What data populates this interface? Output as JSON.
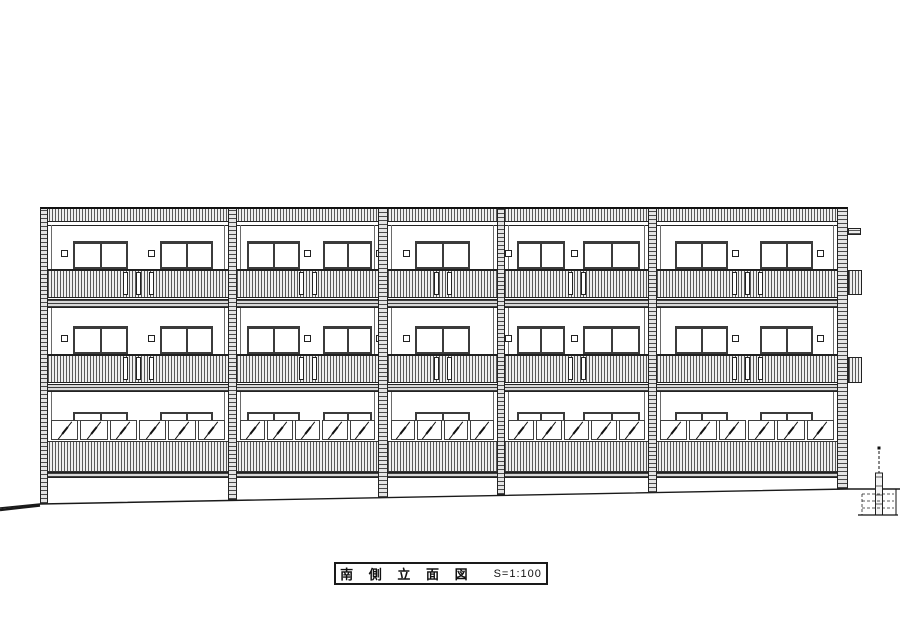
{
  "title_block": {
    "title": "南 側 立 面 図",
    "scale": "S=1:100"
  },
  "drawing": {
    "type": "architectural-elevation-south",
    "canvas": {
      "width": 900,
      "height": 636
    },
    "colors": {
      "line": "#222222",
      "frame": "#3b3b3b",
      "paper": "#ffffff"
    },
    "building": {
      "left": 40,
      "right": 848,
      "top": 207,
      "ground": {
        "pts": "0,508 40,504 848,489 900,489",
        "thick_left": "0,510 40,505.5"
      }
    },
    "levels": {
      "parapet": {
        "top": 207,
        "bottom": 222,
        "subline": 225
      },
      "floors": [
        {
          "name": "3F",
          "window_top": 241,
          "window_bottom": 269,
          "vent_y": 250,
          "balcony_top": 269,
          "balcony_bottom": 298,
          "slab_top": 299,
          "slab_bottom": 308
        },
        {
          "name": "2F",
          "window_top": 326,
          "window_bottom": 354,
          "vent_y": 335,
          "balcony_top": 354,
          "balcony_bottom": 383,
          "slab_top": 384,
          "slab_bottom": 392
        }
      ],
      "ground_floor": {
        "name": "1F",
        "head_top": 412,
        "head_bottom": 421,
        "louver_top": 420,
        "louver_bottom": 440,
        "screen_top": 441,
        "screen_bottom": 472,
        "base_top": 472,
        "base_bottom": 478
      }
    },
    "columns": [
      [
        40,
        48
      ],
      [
        228,
        237
      ],
      [
        378,
        388
      ],
      [
        497,
        505
      ],
      [
        648,
        657
      ],
      [
        837,
        848
      ]
    ],
    "bays": [
      {
        "x": 48,
        "w": 180,
        "vent_side": "left",
        "slots": 3,
        "louvers": 6,
        "windows": [
          {
            "dx": 25,
            "w": 55
          },
          {
            "dx": 112,
            "w": 53
          }
        ]
      },
      {
        "x": 237,
        "w": 141,
        "vent_side": "right",
        "slots": 2,
        "louvers": 5,
        "windows": [
          {
            "dx": 10,
            "w": 53
          },
          {
            "dx": 86,
            "w": 49
          }
        ]
      },
      {
        "x": 388,
        "w": 109,
        "vent_side": "left",
        "slots": 2,
        "louvers": 4,
        "windows": [
          {
            "dx": 27,
            "w": 55
          }
        ]
      },
      {
        "x": 505,
        "w": 143,
        "vent_side": "left",
        "slots": 2,
        "louvers": 5,
        "windows": [
          {
            "dx": 12,
            "w": 48
          },
          {
            "dx": 78,
            "w": 57
          }
        ]
      },
      {
        "x": 657,
        "w": 180,
        "vent_side": "right",
        "slots": 3,
        "louvers": 6,
        "windows": [
          {
            "dx": 18,
            "w": 53
          },
          {
            "dx": 103,
            "w": 53
          }
        ]
      }
    ],
    "right_side": {
      "cap_bar": {
        "x": 848,
        "y": 228,
        "w": 13,
        "h": 7
      },
      "balcony_boxes": [
        {
          "x": 848,
          "y": 270,
          "w": 14,
          "h": 25
        },
        {
          "x": 848,
          "y": 357,
          "w": 14,
          "h": 26
        }
      ]
    },
    "site": {
      "marker": {
        "x": 879,
        "dot_y": 448,
        "dash_top": 451,
        "post_top": 473,
        "post_bottom": 515,
        "post_w": 7
      },
      "steps": {
        "left": 862,
        "right": 898,
        "top": 489,
        "bottom": 515,
        "tread_ys": [
          494,
          501,
          508
        ]
      }
    },
    "title_box": {
      "x": 334,
      "y": 562,
      "w": 214,
      "h": 23
    }
  }
}
